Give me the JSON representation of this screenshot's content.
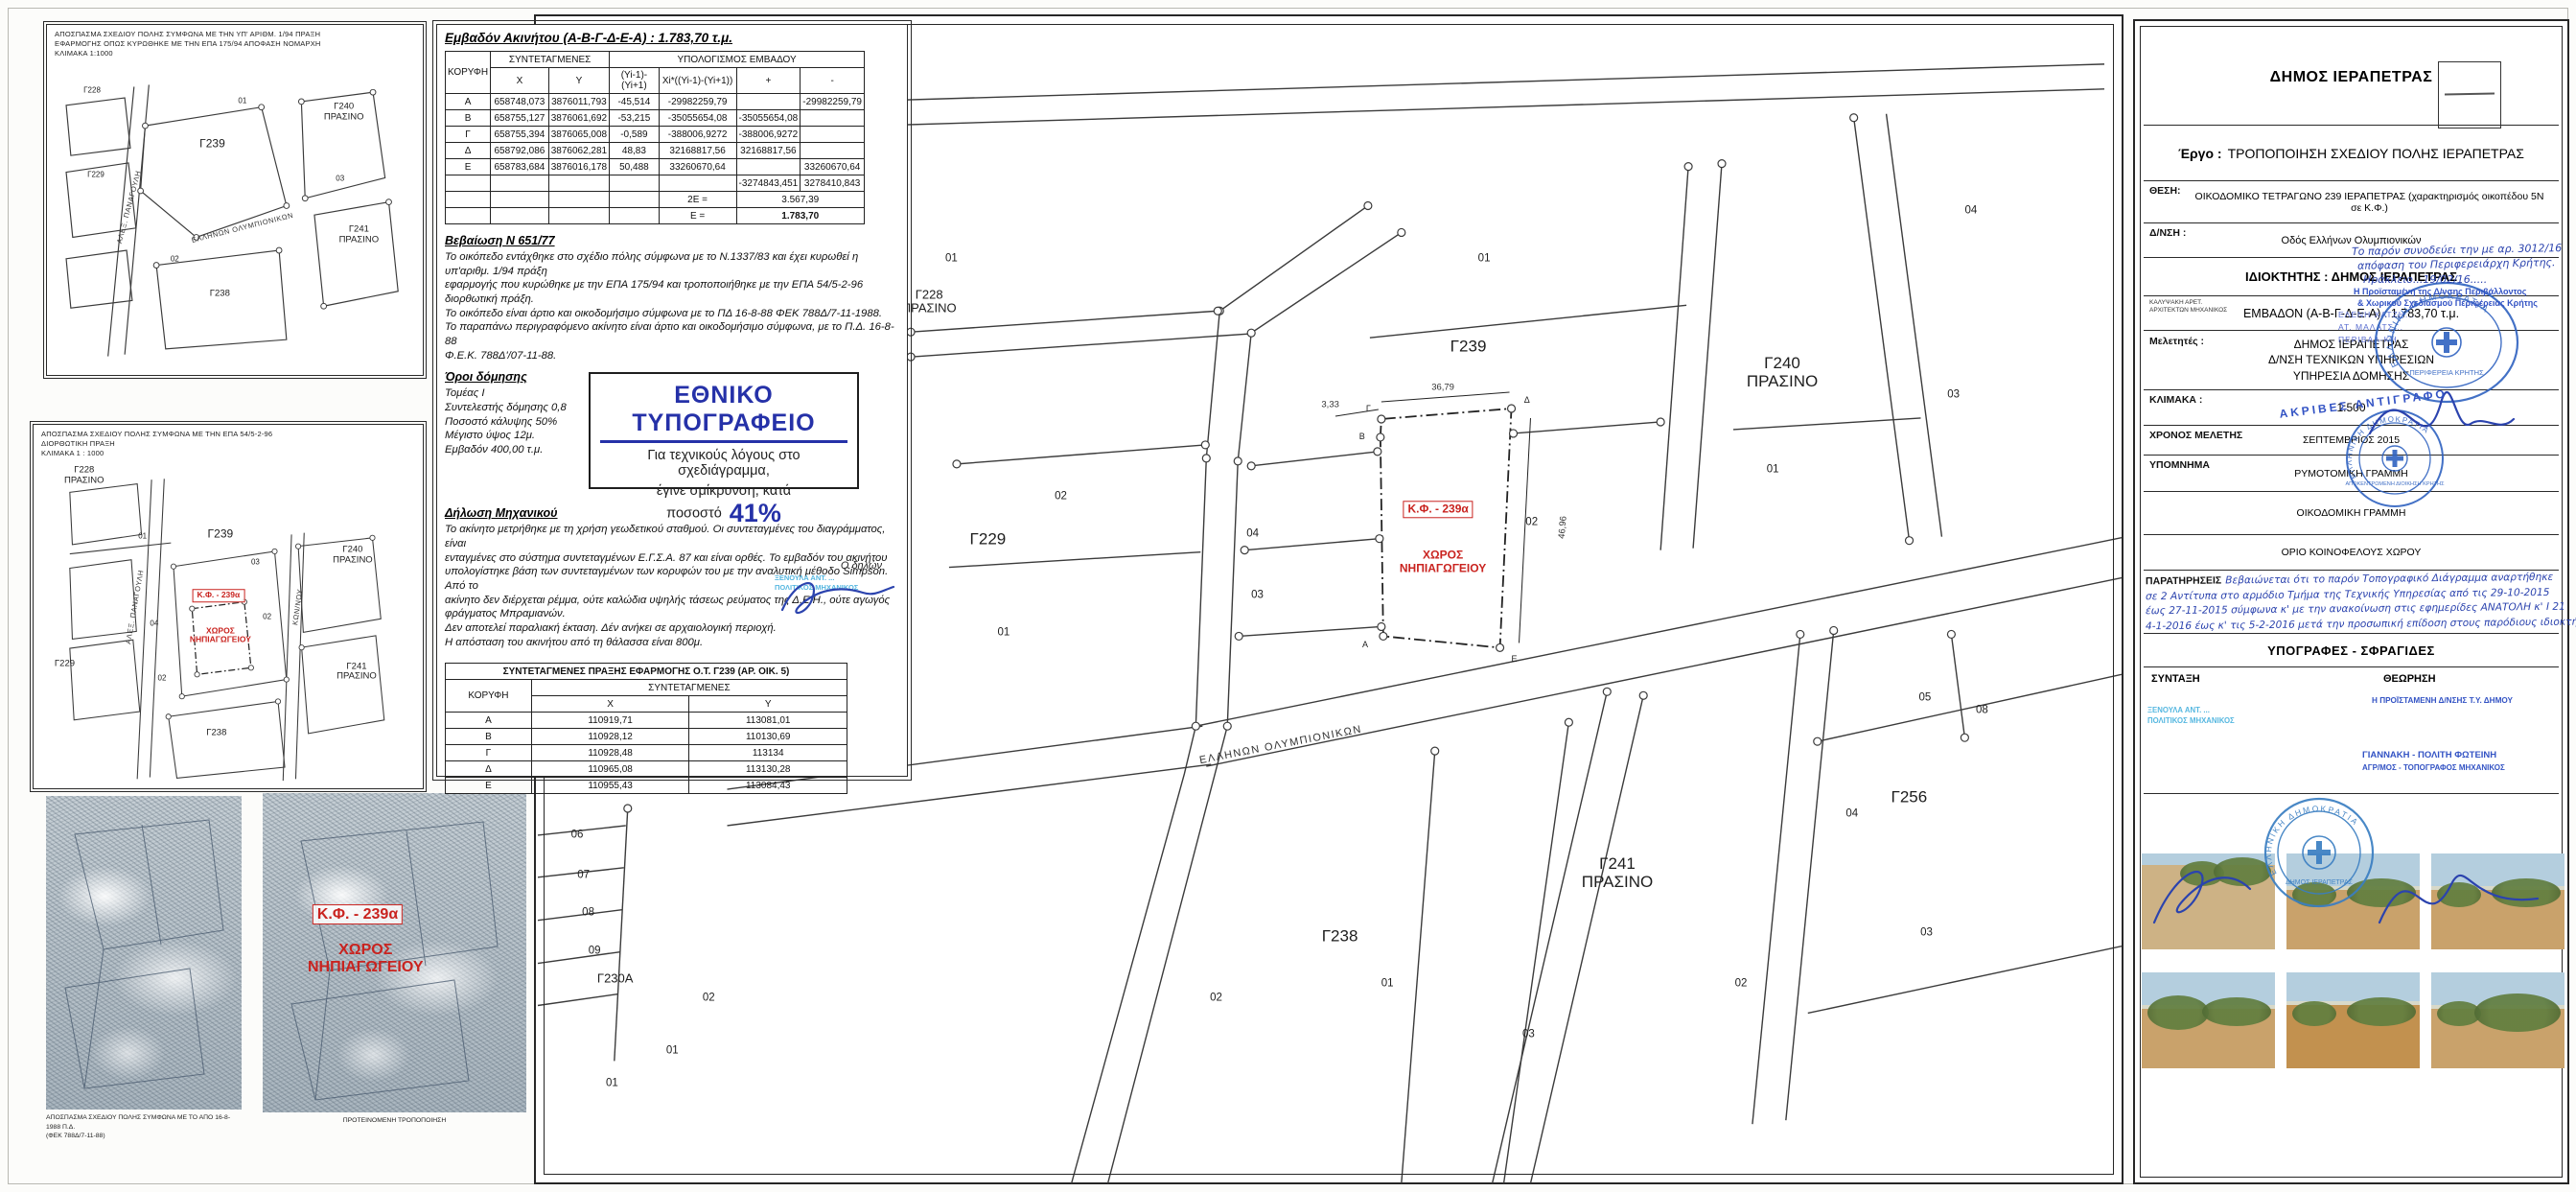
{
  "colors": {
    "red_label": "#c9231f",
    "print_blue": "#2531a8",
    "hand_blue": "#2b43ae",
    "typed_blue": "#3353c4",
    "teal_stamp": "#55b7e0",
    "stamp_blue": "#2f62c0"
  },
  "left_maps": {
    "map1": {
      "caption": [
        "ΑΠΟΣΠΑΣΜΑ ΣΧΕΔΙΟΥ ΠΟΛΗΣ ΣΥΜΦΩΝΑ ΜΕ ΤΗΝ ΥΠ' ΑΡΙΘΜ. 1/94 ΠΡΑΞΗ",
        "ΕΦΑΡΜΟΓΗΣ ΟΠΩΣ ΚΥΡΩΘΗΚΕ ΜΕ ΤΗΝ ΕΠΑ 175/94 ΑΠΟΦΑΣΗ ΝΟΜΑΡΧΗ",
        "ΚΛΙΜΑΚΑ 1:1000"
      ],
      "labels": [
        {
          "t": "Γ228",
          "x": 12,
          "y": 19,
          "k": "sm"
        },
        {
          "t": "Γ229",
          "x": 13,
          "y": 43,
          "k": "sm"
        },
        {
          "t": "01",
          "x": 52,
          "y": 22,
          "k": "sm"
        },
        {
          "t": "Γ239",
          "x": 44,
          "y": 34,
          "k": "lg"
        },
        {
          "t": "Γ240\nΠΡΑΣΙΝΟ",
          "x": 79,
          "y": 25,
          "k": "md"
        },
        {
          "t": "Γ241\nΠΡΑΣΙΝΟ",
          "x": 83,
          "y": 60,
          "k": "md"
        },
        {
          "t": "Γ238",
          "x": 46,
          "y": 77,
          "k": "md"
        },
        {
          "t": "02",
          "x": 34,
          "y": 67,
          "k": "sm"
        },
        {
          "t": "03",
          "x": 78,
          "y": 44,
          "k": "sm"
        },
        {
          "t": "ΑΛΕΞ. ΠΑΝΑΓΟΥΛΗ",
          "x": 22,
          "y": 52,
          "k": "street",
          "r": -75
        },
        {
          "t": "ΕΛΛΗΝΩΝ ΟΛΥΜΠΙΟΝΙΚΩΝ",
          "x": 52,
          "y": 58,
          "k": "street",
          "r": -14
        }
      ]
    },
    "map2": {
      "caption": [
        "ΑΠΟΣΠΑΣΜΑ ΣΧΕΔΙΟΥ ΠΟΛΗΣ ΣΥΜΦΩΝΑ ΜΕ ΤΗΝ ΕΠΑ 54/5-2-96",
        "ΔΙΟΡΘΩΤΙΚΗ ΠΡΑΞΗ",
        "ΚΛΙΜΑΚΑ 1 : 1000"
      ],
      "labels": [
        {
          "t": "Γ228\nΠΡΑΣΙΝΟ",
          "x": 13,
          "y": 14,
          "k": "md"
        },
        {
          "t": "Γ229",
          "x": 8,
          "y": 66,
          "k": "md"
        },
        {
          "t": "Γ239",
          "x": 48,
          "y": 30,
          "k": "lg"
        },
        {
          "t": "Γ240\nΠΡΑΣΙΝΟ",
          "x": 82,
          "y": 36,
          "k": "md"
        },
        {
          "t": "Γ241\nΠΡΑΣΙΝΟ",
          "x": 83,
          "y": 68,
          "k": "md"
        },
        {
          "t": "Γ238",
          "x": 47,
          "y": 85,
          "k": "md"
        },
        {
          "t": "Κ.Φ. - 239α",
          "x": 47.5,
          "y": 47,
          "k": "redbox"
        },
        {
          "t": "ΧΩΡΟΣ\nΝΗΠΙΑΓΩΓΕΙΟΥ",
          "x": 48,
          "y": 58,
          "k": "red"
        },
        {
          "t": "01",
          "x": 28,
          "y": 31,
          "k": "sm"
        },
        {
          "t": "04",
          "x": 31,
          "y": 55,
          "k": "sm"
        },
        {
          "t": "02",
          "x": 60,
          "y": 53,
          "k": "sm"
        },
        {
          "t": "02",
          "x": 33,
          "y": 70,
          "k": "sm"
        },
        {
          "t": "03",
          "x": 57,
          "y": 38,
          "k": "sm"
        },
        {
          "t": "ΑΛΕΞ. ΠΑΝΑΓΟΥΛΗ",
          "x": 26,
          "y": 50,
          "k": "street",
          "r": -80
        },
        {
          "t": "ΚΩΝ/ΝΟΥ",
          "x": 68,
          "y": 50,
          "k": "street",
          "r": -82
        }
      ]
    },
    "scan1_caption": [
      "ΑΠΟΣΠΑΣΜΑ ΣΧΕΔΙΟΥ ΠΟΛΗΣ ΣΥΜΦΩΝΑ ΜΕ ΤΟ ΑΠΟ 16-8-1988 Π.Δ.",
      "(ΦΕΚ 788Δ/7-11-88)"
    ],
    "scan2_caption": "ΠΡΟΤΕΙΝΟΜΕΝΗ ΤΡΟΠΟΠΟΙΗΣΗ",
    "scan2_overlay": {
      "box": "Κ.Φ. - 239α",
      "text": "ΧΩΡΟΣ\nΝΗΠΙΑΓΩΓΕΙΟΥ"
    }
  },
  "area_table": {
    "title": "Εμβαδόν  Ακινήτου  (Α-Β-Γ-Δ-Ε-Α) : 1.783,70 τ.μ.",
    "h_vertex": "ΚΟΡΥΦΗ",
    "h_coords": "ΣΥΝΤΕΤΑΓΜΕΝΕΣ",
    "h_calc": "ΥΠΟΛΟΓΙΣΜΟΣ ΕΜΒΑΔΟΥ",
    "sub": [
      "X",
      "Y",
      "(Yi-1)-(Yi+1)",
      "Xi*((Yi-1)-(Yi+1))",
      "+",
      "-"
    ],
    "rows": [
      [
        "Α",
        "658748,073",
        "3876011,793",
        "-45,514",
        "-29982259,79",
        "",
        "-29982259,79"
      ],
      [
        "Β",
        "658755,127",
        "3876061,692",
        "-53,215",
        "-35055654,08",
        "-35055654,08",
        ""
      ],
      [
        "Γ",
        "658755,394",
        "3876065,008",
        "-0,589",
        "-388006,9272",
        "-388006,9272",
        ""
      ],
      [
        "Δ",
        "658792,086",
        "3876062,281",
        "48,83",
        "32168817,56",
        "32168817,56",
        ""
      ],
      [
        "Ε",
        "658783,684",
        "3876016,178",
        "50,488",
        "33260670,64",
        "",
        "33260670,64"
      ]
    ],
    "sum_row": [
      "",
      "",
      "",
      "",
      "",
      "-3274843,451",
      "3278410,843"
    ],
    "twoE_label": "2Ε =",
    "twoE_value": "3.567,39",
    "E_label": "Ε =",
    "E_value": "1.783,70"
  },
  "cert": {
    "title": "Βεβαίωση  Ν 651/77",
    "lines": [
      "Το οικόπεδο εντάχθηκε στο σχέδιο πόλης σύμφωνα με το Ν.1337/83 και έχει κυρωθεί η υπ'αριθμ. 1/94 πράξη",
      "εφαρμογής που κυρώθηκε με την ΕΠΑ 175/94 και τροποποιήθηκε με την ΕΠΑ 54/5-2-96 διορθωτική πράξη.",
      "Το οικόπεδο είναι άρτιο και οικοδομήσιμο σύμφωνα με το ΠΔ 16-8-88 ΦΕΚ 788Δ/7-11-1988.",
      "Το παραπάνω περιγραφόμενο ακίνητο είναι άρτιο και οικοδομήσιμο σύμφωνα, με το Π.Δ. 16-8-88",
      "Φ.Ε.Κ. 788Δ'/07-11-88."
    ]
  },
  "terms": {
    "title": "Όροι δόμησης",
    "lines": [
      "Τομέας Ι",
      "Συντελεστής δόμησης 0,8",
      "Ποσοστό κάλυψης 50%",
      "Μέγιστο ύψος 12μ.",
      "Εμβαδόν 400,00 τ.μ."
    ]
  },
  "print_note": {
    "brand": "ΕΘΝΙΚΟ ΤΥΠΟΓΡΑΦΕΙΟ",
    "line1": "Για τεχνικούς λόγους στο σχεδιάγραμμα,",
    "line2": "έγινε σμίκρυνση, κατά ποσοστό",
    "pct": "41%"
  },
  "decl": {
    "title": "Δήλωση  Μηχανικού",
    "lines": [
      "Το ακίνητο μετρήθηκε με τη χρήση γεωδετικού σταθμού. Οι συντεταγμένες του διαγράμματος, είναι",
      "ενταγμένες στο σύστημα συντεταγμένων  Ε.Γ.Σ.Α. 87 και είναι ορθές. Το εμβαδόν του ακινήτου",
      "υπολογίστηκε βάση των συντεταγμένων των κορυφών του με την αναλυτική μέθοδο Simpson. Από το",
      "ακίνητο δεν διέρχεται ρέμμα, ούτε καλώδια υψηλής τάσεως ρεύματος της Δ.Ε.Η., ούτε αγωγός",
      "φράγματος Μπραμιανών.",
      "Δεν αποτελεί  παραλιακή  έκταση. Δέν ανήκει  σε αρχαιολογική  περιοχή.",
      "Η απόσταση  του  ακινήτου  από  τη  θάλασσα  είναι 800μ."
    ]
  },
  "declarant": {
    "label": "Ο δηλών",
    "stamp_line1": "ΞΕΝΟΥΛΑ ΑΝΤ. ...",
    "stamp_line2": "ΠΟΛΙΤΙΚΟΣ ΜΗΧΑΝΙΚΟΣ"
  },
  "coords_table": {
    "title": "ΣΥΝΤΕΤΑΓΜΕΝΕΣ ΠΡΑΞΗΣ ΕΦΑΡΜΟΓΗΣ Ο.Τ. Γ239 (ΑΡ. ΟΙΚ. 5)",
    "h_vertex": "ΚΟΡΥΦΗ",
    "h_coords": "ΣΥΝΤΕΤΑΓΜΕΝΕΣ",
    "h_x": "X",
    "h_y": "Y",
    "rows": [
      [
        "Α",
        "110919,71",
        "113081,01"
      ],
      [
        "Β",
        "110928,12",
        "110130,69"
      ],
      [
        "Γ",
        "110928,48",
        "113134"
      ],
      [
        "Δ",
        "110965,08",
        "113130,28"
      ],
      [
        "Ε",
        "110955,43",
        "113084,43"
      ]
    ]
  },
  "main_map": {
    "labels": [
      {
        "t": "01",
        "x": 26.2,
        "y": 20.8,
        "k": "sm"
      },
      {
        "t": "Γ228\nΠΡΑΣΙΝΟ",
        "x": 24.8,
        "y": 24.5,
        "k": "md"
      },
      {
        "t": "01",
        "x": 59.8,
        "y": 20.8,
        "k": "sm"
      },
      {
        "t": "Γ239",
        "x": 58.8,
        "y": 28.3,
        "k": "lg"
      },
      {
        "t": "Γ229",
        "x": 28.5,
        "y": 44.8,
        "k": "lg"
      },
      {
        "t": "02",
        "x": 33.1,
        "y": 41.2,
        "k": "sm"
      },
      {
        "t": "01",
        "x": 29.5,
        "y": 52.9,
        "k": "sm"
      },
      {
        "t": "04",
        "x": 45.2,
        "y": 44.4,
        "k": "sm"
      },
      {
        "t": "03",
        "x": 45.5,
        "y": 49.7,
        "k": "sm"
      },
      {
        "t": "Κ.Φ. - 239α",
        "x": 56.9,
        "y": 42.3,
        "k": "redbox"
      },
      {
        "t": "ΧΩΡΟΣ\nΝΗΠΙΑΓΩΓΕΙΟΥ",
        "x": 57.2,
        "y": 46.8,
        "k": "red"
      },
      {
        "t": "02",
        "x": 62.8,
        "y": 43.4,
        "k": "sm"
      },
      {
        "t": "46,96",
        "x": 64.8,
        "y": 43.8,
        "k": "dim",
        "r": -85
      },
      {
        "t": "36,79",
        "x": 57.2,
        "y": 31.9,
        "k": "dim"
      },
      {
        "t": "3,33",
        "x": 50.1,
        "y": 33.4,
        "k": "dim"
      },
      {
        "t": "Γ240\nΠΡΑΣΙΝΟ",
        "x": 78.6,
        "y": 30.5,
        "k": "lg"
      },
      {
        "t": "03",
        "x": 89.4,
        "y": 32.5,
        "k": "sm"
      },
      {
        "t": "01",
        "x": 78.0,
        "y": 38.9,
        "k": "sm"
      },
      {
        "t": "04",
        "x": 90.5,
        "y": 16.7,
        "k": "sm"
      },
      {
        "t": "05",
        "x": 87.6,
        "y": 58.5,
        "k": "sm"
      },
      {
        "t": "08",
        "x": 91.2,
        "y": 59.5,
        "k": "sm"
      },
      {
        "t": "Γ256",
        "x": 86.6,
        "y": 66.9,
        "k": "lg"
      },
      {
        "t": "04",
        "x": 83.0,
        "y": 68.4,
        "k": "sm"
      },
      {
        "t": "03",
        "x": 87.7,
        "y": 78.6,
        "k": "sm"
      },
      {
        "t": "Γ241\nΠΡΑΣΙΝΟ",
        "x": 68.2,
        "y": 73.4,
        "k": "lg"
      },
      {
        "t": "Γ238",
        "x": 50.7,
        "y": 78.9,
        "k": "lg"
      },
      {
        "t": "01",
        "x": 53.7,
        "y": 83.0,
        "k": "sm"
      },
      {
        "t": "02",
        "x": 42.9,
        "y": 84.2,
        "k": "sm"
      },
      {
        "t": "02",
        "x": 76.0,
        "y": 83.0,
        "k": "sm"
      },
      {
        "t": "03",
        "x": 62.6,
        "y": 87.3,
        "k": "sm"
      },
      {
        "t": "06",
        "x": 2.6,
        "y": 70.2,
        "k": "sm"
      },
      {
        "t": "07",
        "x": 3.0,
        "y": 73.7,
        "k": "sm"
      },
      {
        "t": "08",
        "x": 3.3,
        "y": 76.9,
        "k": "sm"
      },
      {
        "t": "09",
        "x": 3.7,
        "y": 80.2,
        "k": "sm"
      },
      {
        "t": "Γ230Α",
        "x": 5.0,
        "y": 82.6,
        "k": "md"
      },
      {
        "t": "01",
        "x": 4.8,
        "y": 91.5,
        "k": "sm"
      },
      {
        "t": "01",
        "x": 8.6,
        "y": 88.7,
        "k": "sm"
      },
      {
        "t": "02",
        "x": 10.9,
        "y": 84.2,
        "k": "sm"
      },
      {
        "t": "Α",
        "x": 52.3,
        "y": 53.9,
        "k": "tiny"
      },
      {
        "t": "Β",
        "x": 52.1,
        "y": 36.0,
        "k": "tiny"
      },
      {
        "t": "Γ",
        "x": 52.5,
        "y": 33.6,
        "k": "tiny"
      },
      {
        "t": "Δ",
        "x": 62.5,
        "y": 32.9,
        "k": "tiny"
      },
      {
        "t": "Ε",
        "x": 61.7,
        "y": 55.1,
        "k": "tiny"
      },
      {
        "t": "ΕΛΛΗΝΩΝ ΟΛΥΜΠΙΟΝΙΚΩΝ",
        "x": 47.0,
        "y": 62.5,
        "k": "street",
        "r": -11
      }
    ]
  },
  "title_block": {
    "municipality": "ΔΗΜΟΣ ΙΕΡΑΠΕΤΡΑΣ",
    "project_label": "Έργο :",
    "project": "ΤΡΟΠΟΠΟΙΗΣΗ ΣΧΕΔΙΟΥ ΠΟΛΗΣ ΙΕΡΑΠΕΤΡΑΣ",
    "location_label": "ΘΕΣΗ:",
    "location": "ΟΙΚΟΔΟΜΙΚΟ ΤΕΤΡΑΓΩΝΟ 239 ΙΕΡΑΠΕΤΡΑΣ (χαρακτηρισμός οικοπέδου 5Ν σε Κ.Φ.)",
    "address_label": "Δ/ΝΣΗ :",
    "address": "Οδός Ελλήνων Ολυμπιονικών",
    "owner_label": "ΙΔΙΟΚΤΗΤΗΣ :",
    "owner": "ΔΗΜΟΣ ΙΕΡΑΠΕΤΡΑΣ",
    "drafter_line1": "ΚΑΛΥΨΑΚΗ ΑΡΕΤ.",
    "drafter_line2": "ΑΡΧΙΤΕΚΤΩΝ ΜΗΧΑΝΙΚΟΣ",
    "area_label": "ΕΜΒΑΔΟΝ (Α-Β-Γ-Δ-Ε-Α) :",
    "area_value": "1.783,70 τ.μ.",
    "designers_label": "Μελετητές :",
    "designers": [
      "ΔΗΜΟΣ ΙΕΡΑΠΕΤΡΑΣ",
      "Δ/ΝΣΗ ΤΕΧΝΙΚΩΝ ΥΠΗΡΕΣΙΩΝ",
      "ΥΠΗΡΕΣΙΑ ΔΟΜΗΣΗΣ"
    ],
    "scale_label": "ΚΛΙΜΑΚΑ :",
    "scale": "1:500",
    "study_label": "ΧΡΟΝΟΣ ΜΕΛΕΤΗΣ",
    "study": "ΣΕΠΤΕΜΒΡΙΟΣ 2015",
    "legend_label": "ΥΠΟΜΝΗΜΑ",
    "legend": [
      "ΡΥΜΟΤΟΜΙΚΗ ΓΡΑΜΜΗ",
      "ΟΙΚΟΔΟΜΙΚΗ ΓΡΑΜΜΗ",
      "ΟΡΙΟ ΚΟΙΝΟΦΕΛΟΥΣ ΧΩΡΟΥ"
    ]
  },
  "observations": {
    "label": "ΠΑΡΑΤΗΡΗΣΕΙΣ",
    "lines": [
      "Βεβαιώνεται ότι το παρόν Τοπογραφικό Διάγραμμα αναρτήθηκε",
      "σε 2 Αντίτυπα στο αρμόδιο Τμήμα της Τεχνικής Υπηρεσίας από τις 29-10-2015",
      "έως 27-11-2015 σύμφωνα κ' με την ανακοίνωση στις εφημερίδες ΑΝΑΤΟΛΗ κ' Ι 21",
      "4-1-2016 έως κ' τις 5-2-2016 μετά την προσωπική επίδοση στους παρόδιους ιδιοκτήτες"
    ]
  },
  "signatures": {
    "header": "ΥΠΟΓΡΑΦΕΣ - ΣΦΡΑΓΙΔΕΣ",
    "left_label": "ΣΥΝΤΑΞΗ",
    "right_label": "ΘΕΩΡΗΣΗ",
    "left_stamp": [
      "ΞΕΝΟΥΛΑ ΑΝΤ. ...",
      "ΠΟΛΙΤΙΚΟΣ ΜΗΧΑΝΙΚΟΣ"
    ],
    "right_role": "Η ΠΡΟΪΣΤΑΜΕΝΗ Δ/ΝΣΗΣ Τ.Υ. ΔΗΜΟΥ",
    "right_name": "ΓΙΑΝΝΑΚΗ - ΠΟΛΙΤΗ ΦΩΤΕΙΝΗ",
    "right_title": "ΑΓΡ/ΜΟΣ - ΤΟΠΟΓΡΑΦΟΣ ΜΗΧΑΝΙΚΟΣ"
  },
  "stamps": {
    "region": {
      "ring": "ΕΛΛΗΝΙΚΗ ΔΗΜΟΚΡΑΤΙΑ",
      "name": "ΠΕΡΙΦΕΡΕΙΑ ΚΡΗΤΗΣ"
    },
    "admin": {
      "ring": "ΕΛΛΗΝΙΚΗ ΔΗΜΟΚΡΑΤΙΑ",
      "name": "ΑΠΟΚΕΝΤΡΩΜΕΝΗ ΔΙΟΙΚΗΣΗ ΚΡΗΤΗΣ"
    },
    "municipal": {
      "ring": "ΕΛΛΗΝΙΚΗ ΔΗΜΟΚΡΑΤΙΑ",
      "name": "ΔΗΜΟΣ ΙΕΡΑΠΕΤΡΑΣ"
    },
    "certified_copy": "ΑΚΡΙΒΕΣ ΑΝΤΙΓΡΑΦΟ",
    "officer_stamp": [
      "ΕΛΕΝΗ ΧΑΤΖΗ...",
      "ΑΤ. ΜΑΛΑΤΣ...",
      "ΠΕΡΙΒΑΛ-ΚΗ"
    ]
  },
  "region_note": {
    "lines": [
      "Το παρόν συνοδεύει  την με αρ. 3012/16",
      "απόφαση του Περιφερειάρχη Κρήτης.",
      "Ηράκλειο...19/02/16.....",
      "Η Προϊσταμένη της Δ/νσης Περιβάλλοντος",
      "& Χωρικού Σχεδιασμού Περιφέρειας Κρήτης"
    ]
  },
  "photos": {
    "count": 6
  }
}
